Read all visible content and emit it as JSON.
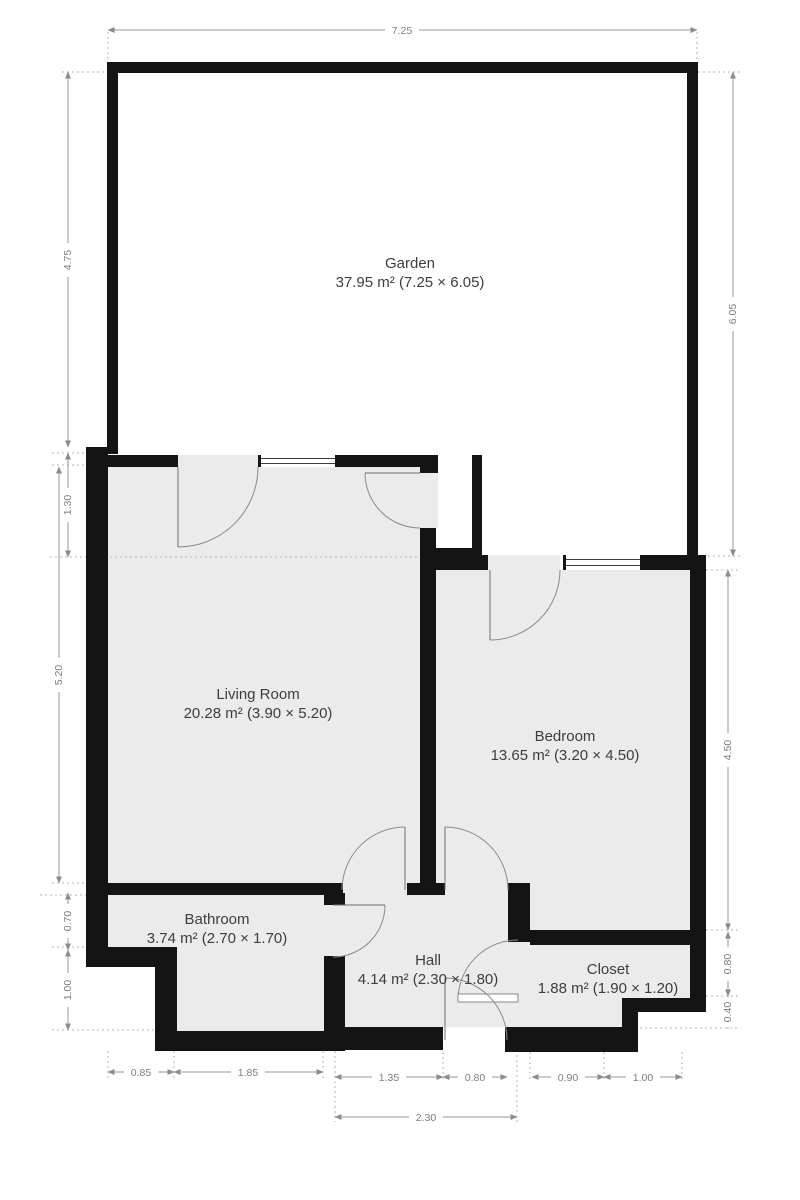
{
  "rooms": {
    "garden": {
      "name": "Garden",
      "area": "37.95 m² (7.25 × 6.05)"
    },
    "living_room": {
      "name": "Living Room",
      "area": "20.28 m² (3.90 × 5.20)"
    },
    "bedroom": {
      "name": "Bedroom",
      "area": "13.65 m² (3.20 × 4.50)"
    },
    "bathroom": {
      "name": "Bathroom",
      "area": "3.74 m² (2.70 × 1.70)"
    },
    "hall": {
      "name": "Hall",
      "area": "4.14 m² (2.30 × 1.80)"
    },
    "closet": {
      "name": "Closet",
      "area": "1.88 m² (1.90 × 1.20)"
    }
  },
  "dimensions": {
    "top_width": "7.25",
    "left_garden": "4.75",
    "left_offset": "1.30",
    "left_living": "5.20",
    "left_bath_upper": "0.70",
    "left_bath_lower": "1.00",
    "right_garden": "6.05",
    "right_bedroom": "4.50",
    "right_closet_upper": "0.80",
    "right_closet_lower": "0.40",
    "bottom_bath_step": "0.85",
    "bottom_bath": "1.85",
    "bottom_hall_left": "1.35",
    "bottom_front_door": "0.80",
    "bottom_closet_left": "0.90",
    "bottom_closet_right": "1.00",
    "bottom_hall_total": "2.30"
  },
  "colors": {
    "wall": "#141414",
    "floor": "#ebebeb",
    "dimension": "#979797",
    "room_text": "#3d3d3d",
    "background": "#ffffff"
  }
}
